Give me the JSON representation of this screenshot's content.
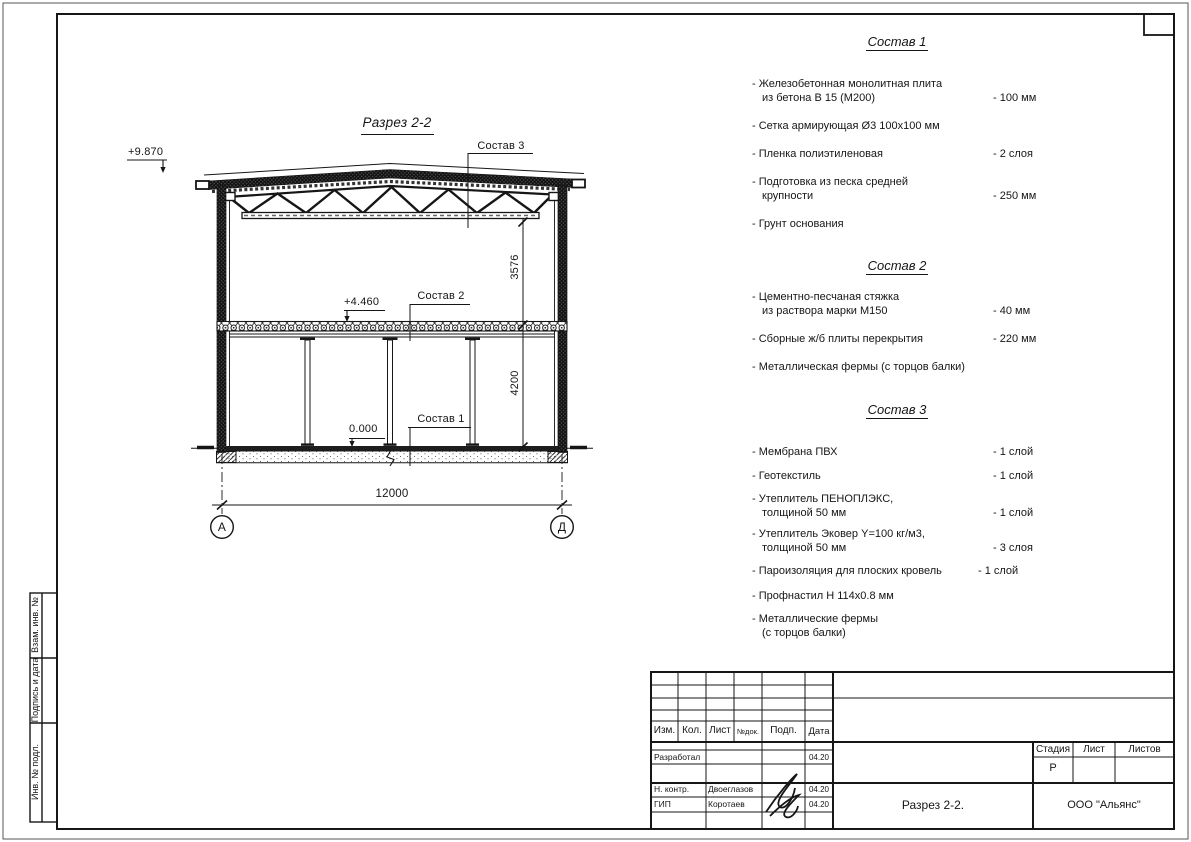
{
  "drawing": {
    "title": "Разрез 2-2",
    "elev_top": "+9.870",
    "elev_mid": "+4.460",
    "elev_zero": "0.000",
    "dim_vert_upper": "3576",
    "dim_vert_lower": "4200",
    "dim_span": "12000",
    "axis_left": "А",
    "axis_right": "Д",
    "leader_s1": "Состав 1",
    "leader_s2": "Состав 2",
    "leader_s3": "Состав 3"
  },
  "specs": {
    "s1": {
      "title": "Состав 1",
      "items": [
        {
          "l1": "- Железобетонная  монолитная плита",
          "l2": "из бетона В 15 (М200)",
          "v": "- 100 мм"
        },
        {
          "l1": "- Сетка армирующая Ø3 100х100 мм",
          "l2": "",
          "v": ""
        },
        {
          "l1": "- Пленка полиэтиленовая",
          "l2": "",
          "v": "-  2 слоя"
        },
        {
          "l1": "- Подготовка из песка средней",
          "l2": "крупности",
          "v": "- 250 мм"
        },
        {
          "l1": "- Грунт основания",
          "l2": "",
          "v": ""
        }
      ]
    },
    "s2": {
      "title": "Состав 2",
      "items": [
        {
          "l1": "- Цементно-песчаная стяжка",
          "l2": "из раствора марки М150",
          "v": "- 40 мм"
        },
        {
          "l1": "- Сборные ж/б плиты перекрытия",
          "l2": "",
          "v": "- 220 мм"
        },
        {
          "l1": "- Металлическая фермы (с торцов балки)",
          "l2": "",
          "v": ""
        }
      ]
    },
    "s3": {
      "title": "Состав 3",
      "items": [
        {
          "l1": "- Мембрана ПВХ",
          "l2": "",
          "v": "- 1 слой"
        },
        {
          "l1": "- Геотекстиль",
          "l2": "",
          "v": "- 1 слой"
        },
        {
          "l1": "- Утеплитель ПЕНОПЛЭКС,",
          "l2": "толщиной 50 мм",
          "v": "- 1 слой"
        },
        {
          "l1": "- Утеплитель Эковер Y=100 кг/м3,",
          "l2": "толщиной 50 мм",
          "v": "- 3 слоя"
        },
        {
          "l1": "- Пароизоляция для плоских кровель",
          "l2": "",
          "v": "- 1 слой"
        },
        {
          "l1": "- Профнастил Н 114х0.8 мм",
          "l2": "",
          "v": ""
        },
        {
          "l1": "- Металлические фермы",
          "l2": "(с торцов балки)",
          "v": ""
        }
      ]
    }
  },
  "stamp": {
    "cols": {
      "izm": "Изм.",
      "kol": "Кол.",
      "list": "Лист",
      "ndok": "№док.",
      "podp": "Подп.",
      "data": "Дата"
    },
    "rows": [
      {
        "role": "Разработал",
        "name": "",
        "date": "04.20"
      },
      {
        "role": "Н. контр.",
        "name": "Двоеглазов",
        "date": "04.20"
      },
      {
        "role": "ГИП",
        "name": "Коротаев",
        "date": "04.20"
      }
    ],
    "stage": {
      "stadia": "Стадия",
      "list": "Лист",
      "listov": "Листов",
      "value": "Р"
    },
    "doc_title": "Разрез 2-2.",
    "company": "ООО \"Альянс\""
  },
  "side": {
    "vzam": "Взам. инв. №",
    "podp": "Подпись и дата",
    "inv": "Инв. № подл."
  },
  "ink": "#161616"
}
